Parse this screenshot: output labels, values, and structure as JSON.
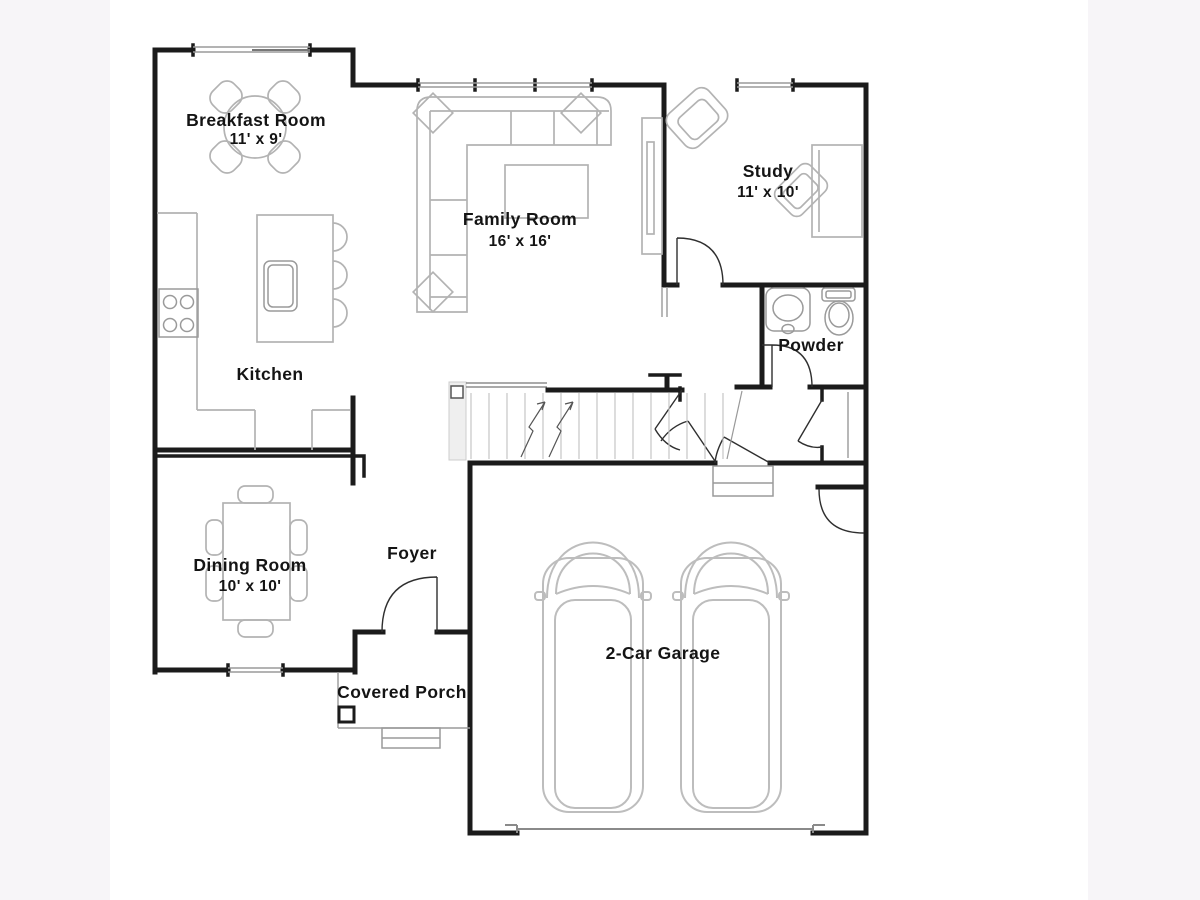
{
  "canvas": {
    "background": "#f7f5f8",
    "paper": "#ffffff"
  },
  "palette": {
    "wall": "#1b1b1b",
    "furniture_outline": "#b3b3b3",
    "fixture_outline": "#9a9a9a",
    "label_text": "#141414"
  },
  "rooms": {
    "breakfast": {
      "name": "Breakfast Room",
      "dims": "11' x 9'"
    },
    "family": {
      "name": "Family Room",
      "dims": "16' x 16'"
    },
    "study": {
      "name": "Study",
      "dims": "11' x 10'"
    },
    "kitchen": {
      "name": "Kitchen"
    },
    "powder": {
      "name": "Powder"
    },
    "dining": {
      "name": "Dining Room",
      "dims": "10' x 10'"
    },
    "foyer": {
      "name": "Foyer"
    },
    "porch": {
      "name": "Covered Porch"
    },
    "garage": {
      "name": "2-Car Garage"
    }
  }
}
